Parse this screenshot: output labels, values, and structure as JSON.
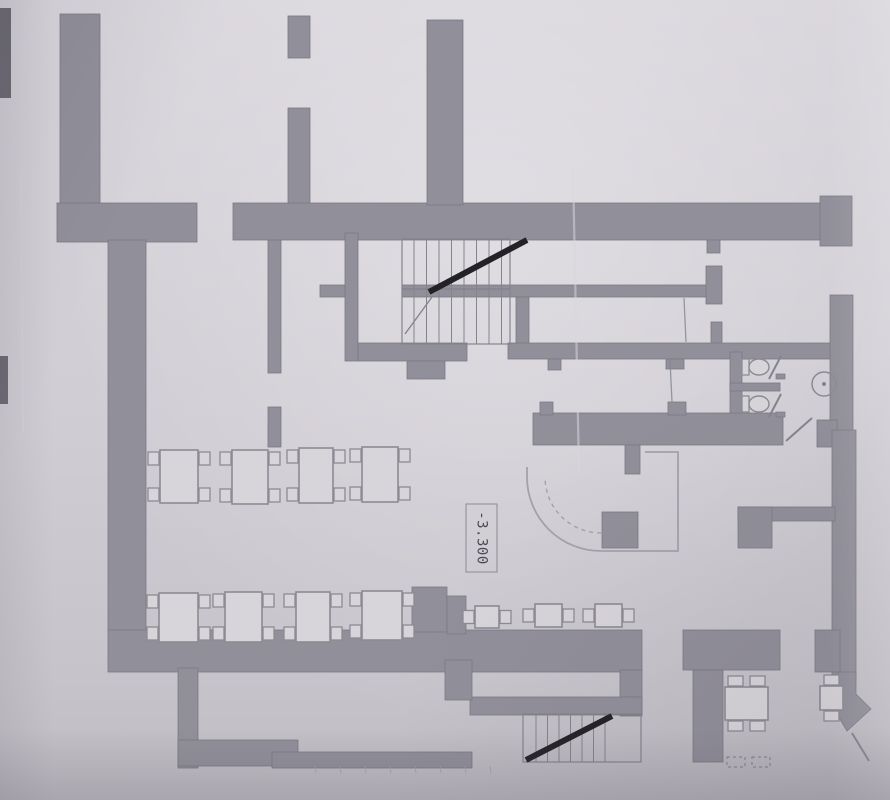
{
  "document": {
    "kind": "scanned-architectural-floor-plan",
    "elevation_label": {
      "text": "-3.300"
    }
  },
  "colors": {
    "paper": "#cfccd3",
    "wall_fill": "#918f99",
    "wall_edge": "#7b7983",
    "thin_line": "#85848d",
    "light_line": "#a3a2aa",
    "dark_ink": "#232227",
    "furniture_fill": "#d8d5da",
    "furniture_line": "#8c8b93",
    "text": "#4a4952",
    "crease": "#d9d6dd",
    "edge_mark": "#5a5860"
  },
  "plan": {
    "walls": [
      [
        60,
        14,
        40,
        226
      ],
      [
        57,
        203,
        140,
        39
      ],
      [
        108,
        240,
        38,
        392
      ],
      [
        288,
        16,
        22,
        42
      ],
      [
        288,
        108,
        22,
        99
      ],
      [
        233,
        203,
        590,
        37
      ],
      [
        820,
        196,
        32,
        50
      ],
      [
        427,
        20,
        36,
        185
      ],
      [
        268,
        240,
        13,
        133
      ],
      [
        268,
        407,
        13,
        40
      ],
      [
        345,
        233,
        13,
        128
      ],
      [
        320,
        285,
        25,
        12
      ],
      [
        402,
        285,
        310,
        12
      ],
      [
        706,
        266,
        16,
        38
      ],
      [
        707,
        240,
        13,
        13
      ],
      [
        711,
        322,
        11,
        23
      ],
      [
        516,
        297,
        13,
        48
      ],
      [
        508,
        343,
        324,
        16
      ],
      [
        358,
        343,
        109,
        18
      ],
      [
        407,
        361,
        38,
        18
      ],
      [
        548,
        359,
        13,
        11
      ],
      [
        666,
        359,
        18,
        10
      ],
      [
        830,
        295,
        23,
        137
      ],
      [
        730,
        352,
        12,
        66
      ],
      [
        730,
        383,
        50,
        8
      ],
      [
        533,
        413,
        250,
        32
      ],
      [
        540,
        402,
        13,
        13
      ],
      [
        668,
        402,
        18,
        13
      ],
      [
        625,
        445,
        15,
        29
      ],
      [
        817,
        420,
        20,
        27
      ],
      [
        832,
        430,
        24,
        250
      ],
      [
        738,
        507,
        97,
        14
      ],
      [
        738,
        507,
        34,
        41
      ],
      [
        602,
        512,
        36,
        36
      ],
      [
        108,
        630,
        534,
        42
      ],
      [
        412,
        587,
        35,
        45
      ],
      [
        447,
        596,
        19,
        38
      ],
      [
        620,
        670,
        22,
        46
      ],
      [
        470,
        697,
        172,
        18
      ],
      [
        445,
        660,
        27,
        40
      ],
      [
        178,
        668,
        20,
        100
      ],
      [
        178,
        740,
        120,
        26
      ],
      [
        272,
        752,
        200,
        16
      ],
      [
        683,
        630,
        97,
        40
      ],
      [
        693,
        670,
        30,
        92
      ],
      [
        815,
        630,
        25,
        42
      ]
    ],
    "chevron_wall": "838,672 856,672 856,694 871,709 847,731 838,716",
    "stairs": [
      {
        "name": "staircase-upper",
        "outline": [
          402,
          239,
          108,
          105
        ],
        "tread_x": [
          414,
          502,
          12.5
        ],
        "tread_y": [
          239,
          344
        ],
        "divider": [
          402,
          289,
          510,
          289
        ],
        "thick": [
          [
            429,
            292,
            527,
            240
          ]
        ],
        "thin": [
          [
            405,
            334,
            432,
            297
          ]
        ]
      },
      {
        "name": "staircase-lower",
        "outline": [
          523,
          714,
          118,
          48
        ],
        "tread_x": [
          536,
          614,
          11.5
        ],
        "tread_y": [
          714,
          762
        ],
        "thick": [
          [
            526,
            760,
            612,
            716
          ]
        ]
      }
    ],
    "bar_counter": {
      "outer": "M 645 452 L 678 452 L 678 551 L 601 551 A 74 74 0 0 1 527 477 L 527 467",
      "inner_dashed": "M 601 533 A 56 56 0 0 1 545 477"
    },
    "tables": [
      [
        160,
        450,
        38,
        53,
        "lr2"
      ],
      [
        232,
        450,
        36,
        54,
        "lr2"
      ],
      [
        299,
        448,
        34,
        55,
        "lr2"
      ],
      [
        362,
        447,
        36,
        55,
        "lr2"
      ],
      [
        159,
        593,
        39,
        49,
        "lr2"
      ],
      [
        225,
        592,
        37,
        50,
        "lr2"
      ],
      [
        296,
        592,
        34,
        50,
        "lr2"
      ],
      [
        362,
        591,
        40,
        49,
        "lr2"
      ],
      [
        475,
        606,
        24,
        22,
        "lr1"
      ],
      [
        535,
        604,
        27,
        23,
        "lr1"
      ],
      [
        595,
        604,
        27,
        23,
        "lr1"
      ],
      [
        725,
        687,
        43,
        33,
        "tb2"
      ],
      [
        820,
        686,
        23,
        24,
        "tb1"
      ]
    ],
    "toilets": [
      {
        "cx": 760,
        "cy": 367
      },
      {
        "cx": 760,
        "cy": 404
      }
    ],
    "door_posts": [
      [
        776,
        374,
        9,
        5
      ],
      [
        776,
        412,
        9,
        5
      ]
    ],
    "fixture_circle": {
      "cx": 824,
      "cy": 384,
      "r": 12
    },
    "door_lines": [
      [
        781,
        356,
        769,
        379
      ],
      [
        781,
        394,
        769,
        417
      ],
      [
        786,
        441,
        812,
        418
      ],
      [
        852,
        733,
        869,
        761
      ]
    ],
    "thin_lines": [
      [
        670,
        360,
        672,
        402
      ],
      [
        684,
        298,
        686,
        342
      ]
    ],
    "dashed_chairs": [
      [
        727,
        757,
        18,
        10
      ],
      [
        752,
        757,
        18,
        10
      ]
    ],
    "ticks": {
      "y1": 766,
      "y2": 773,
      "xs": [
        315,
        340,
        365,
        390,
        415,
        440,
        465,
        490
      ]
    },
    "creases": [
      {
        "x1": 573,
        "y1": 170,
        "x2": 579,
        "y2": 472,
        "w": 2.2
      },
      {
        "x1": 20,
        "y1": 0,
        "x2": 23,
        "y2": 432,
        "w": 1.6
      }
    ],
    "edge_marks": [
      [
        0,
        8,
        11,
        90
      ],
      [
        0,
        356,
        8,
        48
      ]
    ],
    "label_box": {
      "x": 466,
      "y": 504,
      "w": 31,
      "h": 68,
      "cx": 481.5,
      "cy": 538
    }
  }
}
